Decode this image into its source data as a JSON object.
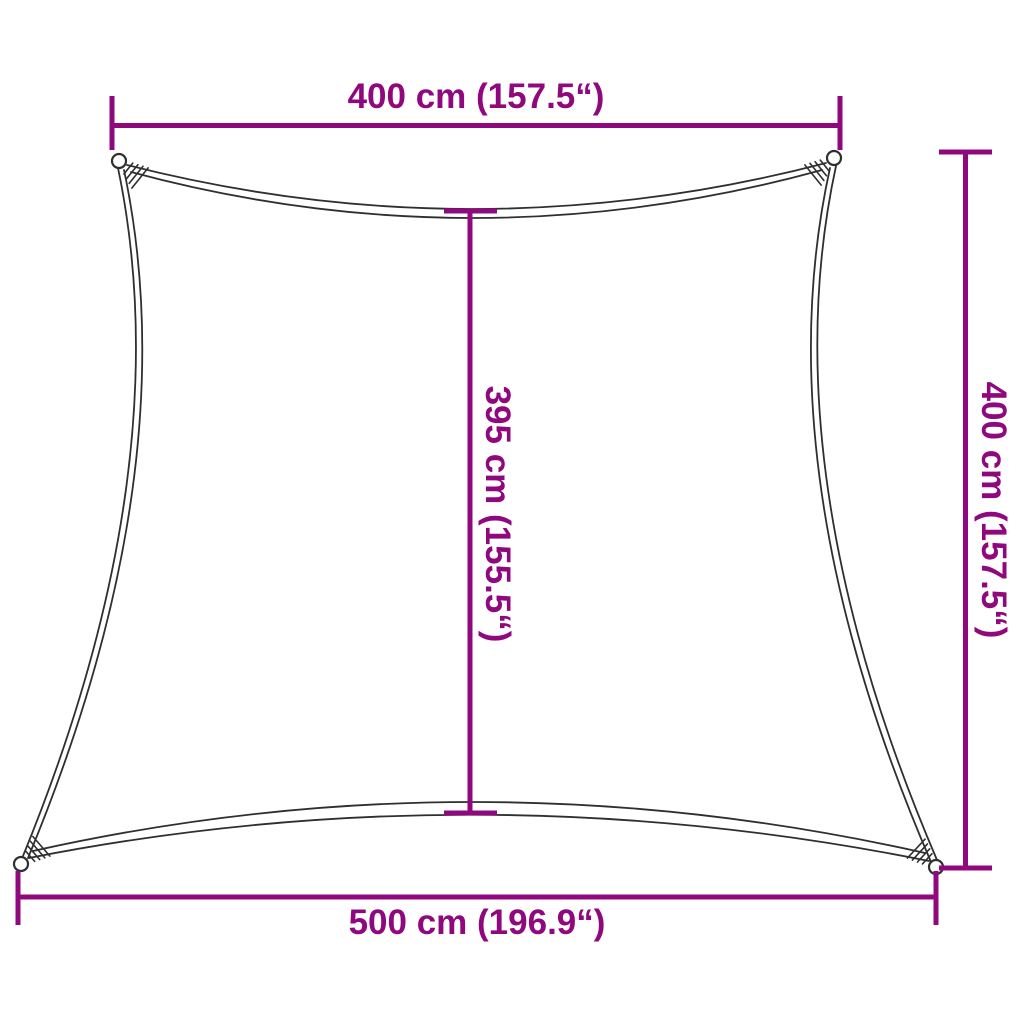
{
  "diagram": {
    "type": "product-dimension-diagram",
    "subject": "shade-sail-outline",
    "colors": {
      "dimension_accent": "#90087D",
      "outline": "#2F2F2F",
      "background": "#FFFFFF"
    },
    "dimensions": {
      "top": "400 cm (157.5“)",
      "right": "400 cm (157.5“)",
      "middle": "395 cm (155.5“)",
      "bottom": "500 cm (196.9“)"
    }
  }
}
